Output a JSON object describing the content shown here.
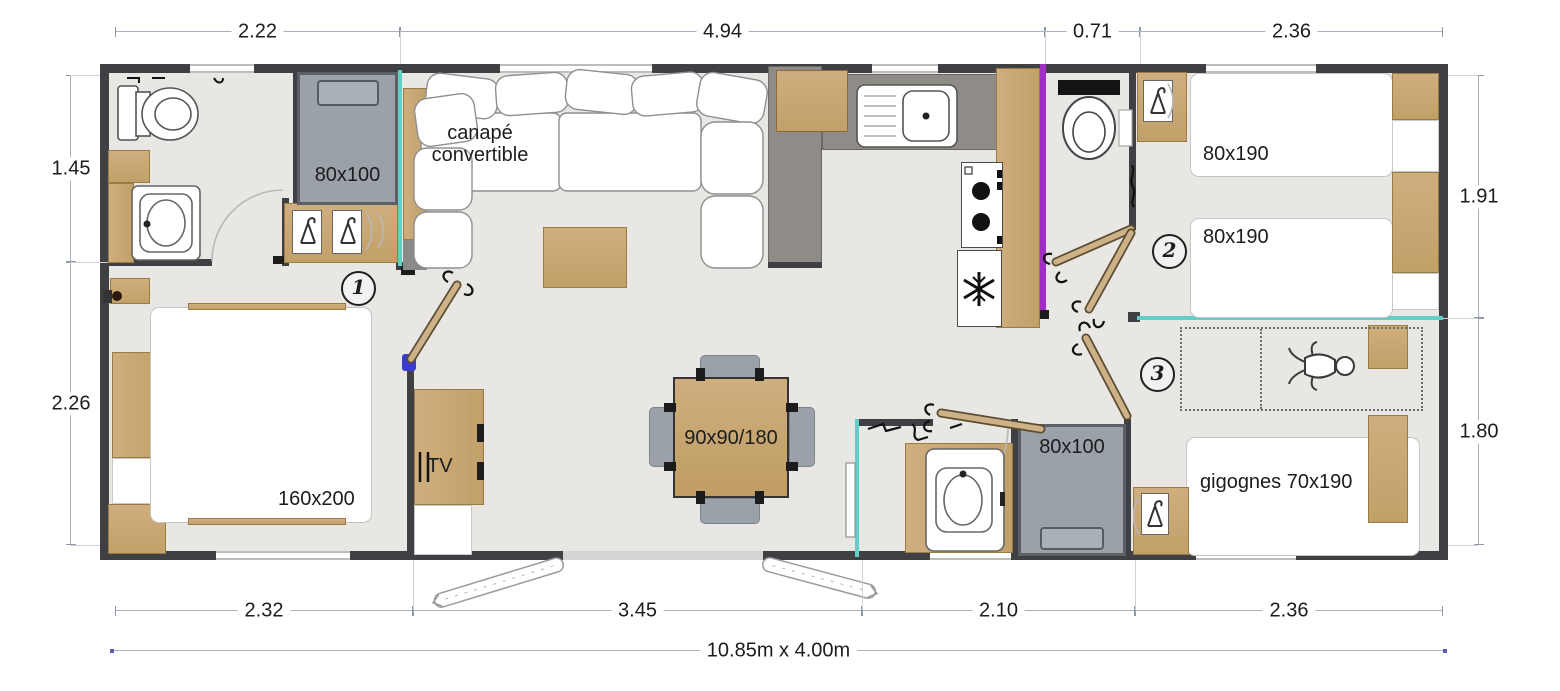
{
  "dims": {
    "top": [
      "2.22",
      "4.94",
      "0.71",
      "2.36"
    ],
    "bottom": [
      "2.32",
      "3.45",
      "2.10",
      "2.36"
    ],
    "left": [
      "1.45",
      "2.26"
    ],
    "right": [
      "1.91",
      "1.80"
    ],
    "overall": "10.85m x 4.00m"
  },
  "labels": {
    "sofa": "canapé convertible",
    "bunk_bed_1": "80x100",
    "bunk_bed_2": "80x100",
    "master_bed": "160x200",
    "dining_table": "90x90/180",
    "tv": "TV",
    "twin_bed_1": "80x190",
    "twin_bed_2": "80x190",
    "gigognes_bed": "gigognes 70x190"
  },
  "rooms": [
    {
      "number": "1"
    },
    {
      "number": "2"
    },
    {
      "number": "3"
    }
  ],
  "icons": {
    "toilet": "toilet-icon",
    "sink": "sink-icon",
    "hanger": "hanger-icon",
    "snowflake": "snowflake-icon",
    "stove": "stove-burners-icon",
    "baby": "baby-icon",
    "door_leaf": "door-leaf-icon",
    "door_arc": "door-swing-arc"
  },
  "colors": {
    "wall": "#3e4043",
    "floor": "#e9e7e4",
    "wood": "#c9ab77",
    "bed_gray": "#9ba1a9",
    "accent_purple": "#a12cc6",
    "accent_teal": "#5fcfc7",
    "hinge_blue": "#3c3ccd",
    "dim_line": "#a7b0ba"
  }
}
